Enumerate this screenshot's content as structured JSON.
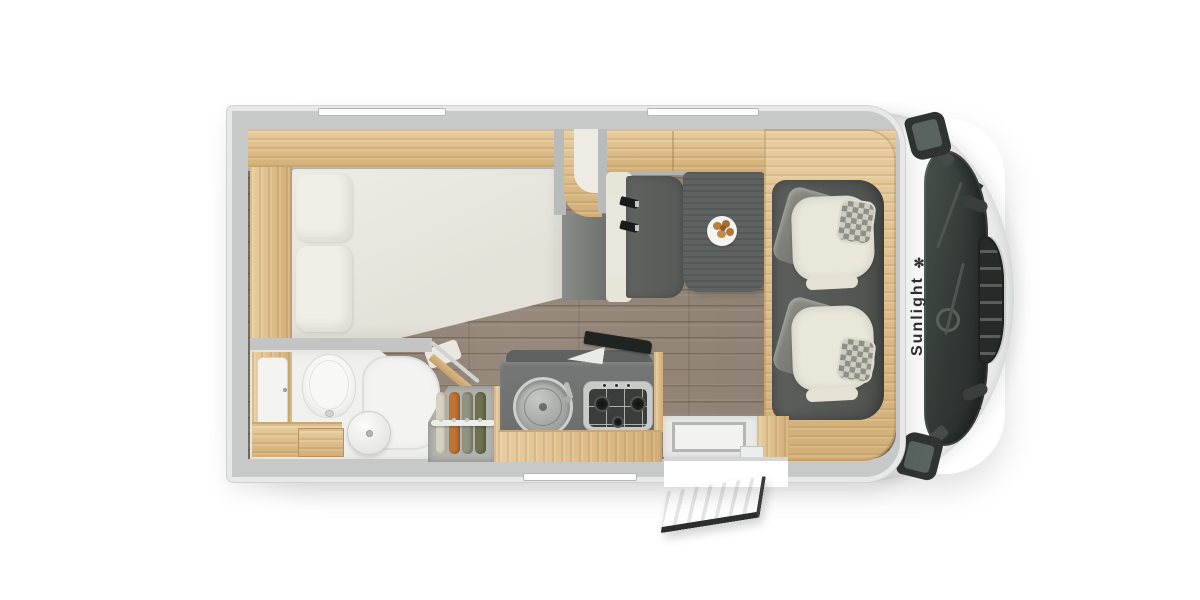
{
  "scene": {
    "title": "Motorhome floor plan, top-down view",
    "background": "#ffffff"
  },
  "brand": {
    "wordmark": "Sunlight",
    "logo_glyph": "✻"
  },
  "colors": {
    "wall": "#c7c9c8",
    "wall-lip": "#e7e8e7",
    "wood-light": "#e9cd9f",
    "wood-dark": "#d2ae76",
    "floor-base": "#8e8174",
    "cab-floor": "#595c59",
    "counter": "#6c6f6d",
    "table": "#5e6260",
    "bench": "#5b5e5c",
    "mattress": "#eae8e0",
    "fixture-white": "#f0f1ef",
    "seat-cream": "#e9e6da",
    "seat-gray": "#7f8179",
    "checker-light": "#cfccc0",
    "checker-dark": "#8e9088",
    "glass-dark": "#333b37",
    "cab-white": "#f6f7f6",
    "clothes-orange": "#c07434",
    "clothes-olive": "#6e7150",
    "clothes-sage": "#90937f",
    "clothes-cream": "#d7d2c0",
    "pastry": "#b67a3c"
  },
  "fixtures": {
    "skylights_count": 2,
    "bed": "rear-bed-with-2-pillows",
    "bathroom": [
      "toilet",
      "round-washbasin",
      "shower-tray",
      "vanity-cabinet"
    ],
    "wardrobe_hanging_items": 4,
    "kitchen": [
      "round-sink",
      "gas-hob",
      "hob-lid-open",
      "faucet"
    ],
    "hob_burners_count": 3,
    "hob_knobs_count": 3,
    "dinette": [
      "bench-with-seatbelts",
      "table",
      "plate-of-pastries"
    ],
    "seatbelts_count": 2,
    "pastries_count": 5,
    "cab": [
      "passenger-seat",
      "driver-seat",
      "steering-wheel",
      "wipers",
      "side-mirrors",
      "radiator-grille"
    ],
    "cab_seats_count": 2,
    "entrance": "door-open-outward"
  }
}
